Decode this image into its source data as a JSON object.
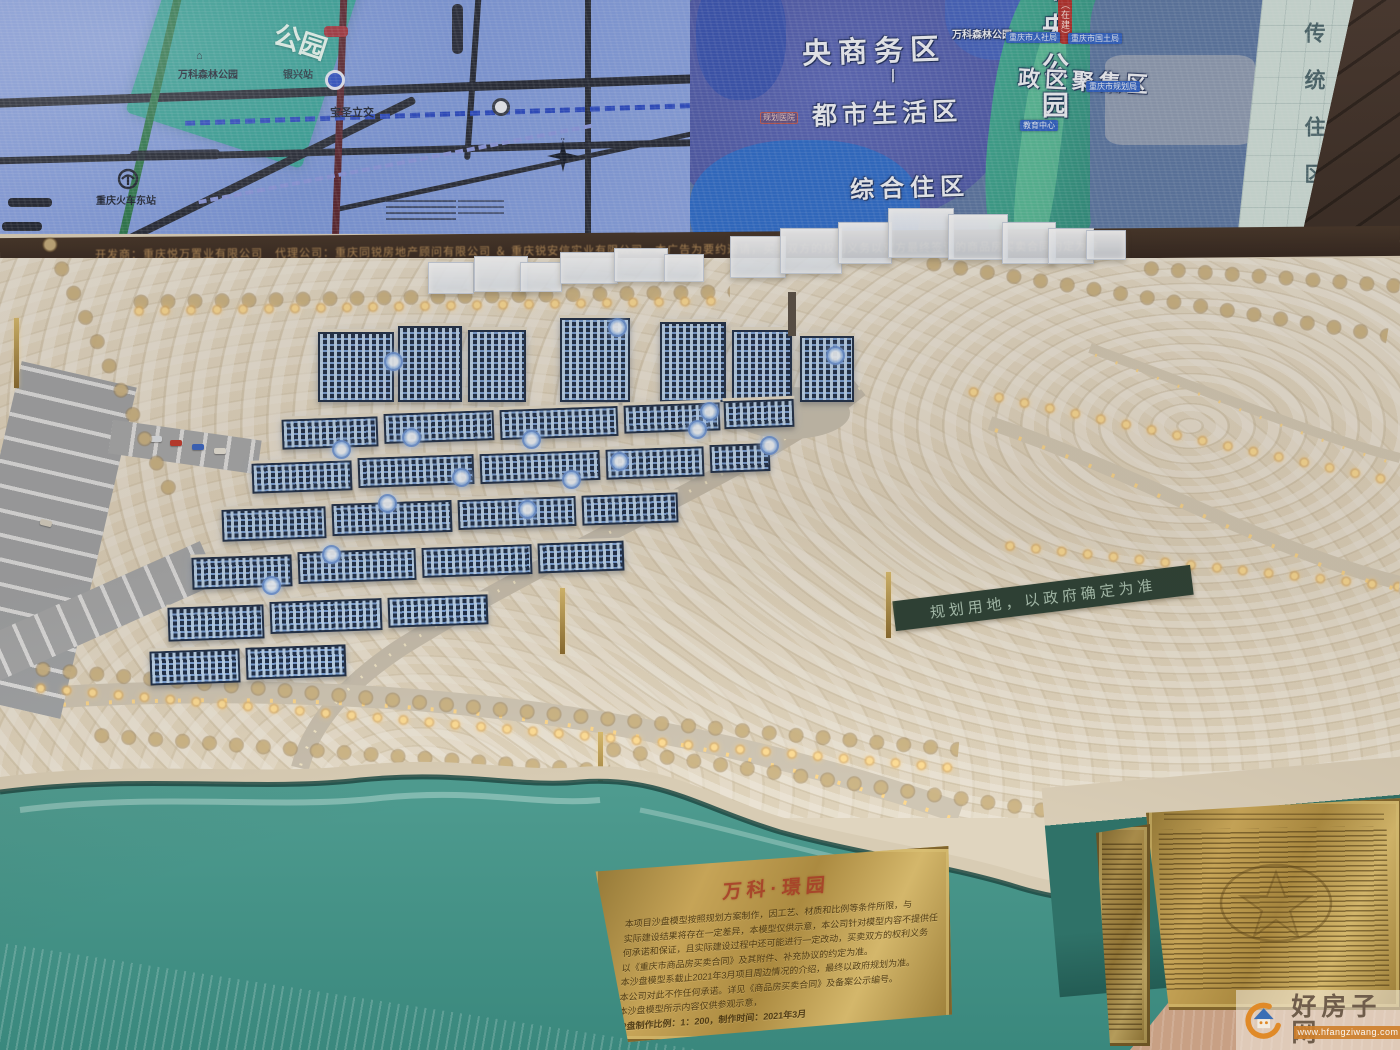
{
  "screen": {
    "left_map": {
      "park_label": "公园",
      "forest_park": "万科森林公园",
      "station": "银兴站",
      "interchange": "宝圣立交",
      "railway_station": "重庆火车东站",
      "compass": {
        "n": "N",
        "e": "E",
        "s": "S",
        "w": "W"
      }
    },
    "right_map": {
      "cbd": "央商务区",
      "divider": "丨",
      "urban_living": "都市生活区",
      "forest_park_small": "万科森林公园",
      "hospital_badge": "规划医院",
      "central_park": "中央公园",
      "gov_cluster": "政区聚集区",
      "under_construction": "（在建）",
      "bureau_hr": "重庆市人社局",
      "bureau_land": "重庆市国土局",
      "bureau_plan": "重庆市规划局",
      "edu_center": "教育中心",
      "mixed_residence": "综合住区",
      "traditional_residence": "传统住区"
    }
  },
  "led_bar": {
    "disclaimer": "开发商：重庆悦万置业有限公司　代理公司：重庆同锐房地产顾问有限公司 ＆ 重庆锐安信实业有限公司　本广告为要约邀请，买卖双方的权利义务以双方最终签订的商品房买卖合同约定为准"
  },
  "model": {
    "land_banner": "规划用地，以政府确定为准"
  },
  "plaque": {
    "logo": "万科·璟园",
    "lines": [
      "本项目沙盘模型按照规划方案制作，因工艺、材质和比例等条件所限，与",
      "实际建设结果将存在一定差异，本模型仅供示意，本公司针对模型内容不提供任",
      "何承诺和保证，且实际建设过程中还可能进行一定改动，买卖双方的权利义务",
      "以《重庆市商品房买卖合同》及其附件、补充协议的约定为准。",
      "本沙盘模型系截止2021年3月项目周边情况的介绍，最终以政府规划为准。",
      "本公司对此不作任何承诺。详见《商品房买卖合同》及备案公示编号。",
      "本沙盘模型所示内容仅供参观示意，",
      "沙盘制作比例：1：200，制作时间：2021年3月"
    ]
  },
  "watermark": {
    "site_name": "好房子网",
    "site_url": "www.hfangziwang.com"
  }
}
